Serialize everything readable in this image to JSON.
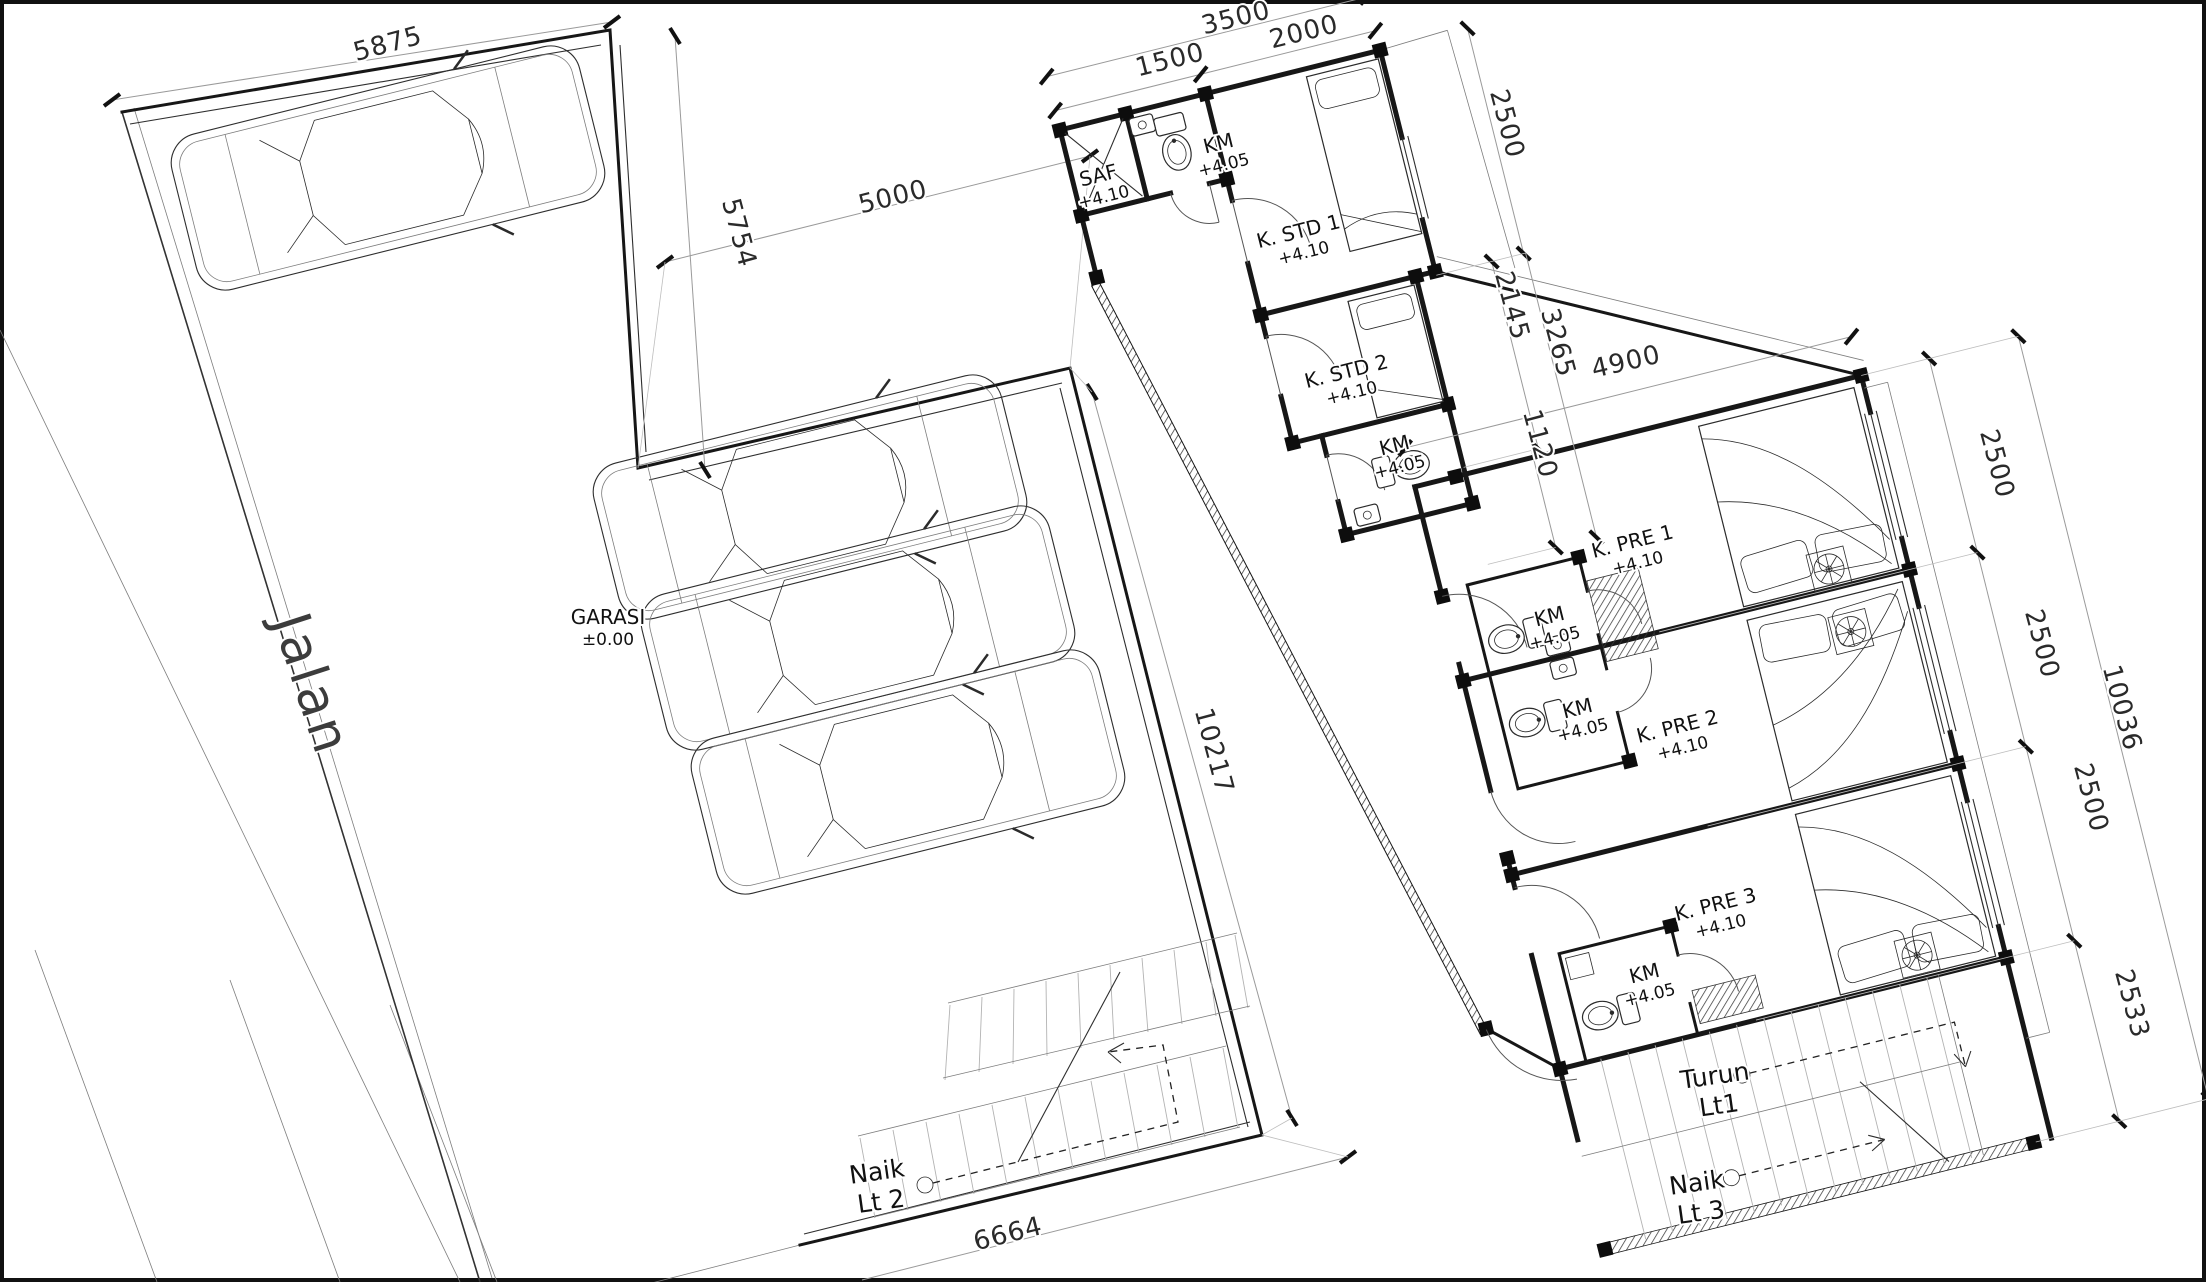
{
  "drawing": {
    "site": {
      "text": "Jalan",
      "x": 295,
      "y": 690,
      "rot": 72
    },
    "rooms": [
      {
        "name": "GARASI",
        "elev": "±0.00",
        "x": 608,
        "y": 624,
        "rot": 0
      },
      {
        "name": "SAF",
        "elev": "+4.10",
        "x": 1100,
        "y": 182,
        "rot": -14
      },
      {
        "name": "KM",
        "elev": "+4.05",
        "x": 1220,
        "y": 150,
        "rot": -14
      },
      {
        "name": "K. STD 1",
        "elev": "+4.10",
        "x": 1300,
        "y": 238,
        "rot": -14
      },
      {
        "name": "K. STD 2",
        "elev": "+4.10",
        "x": 1348,
        "y": 378,
        "rot": -14
      },
      {
        "name": "KM",
        "elev": "+4.05",
        "x": 1396,
        "y": 452,
        "rot": -14
      },
      {
        "name": "K. PRE 1",
        "elev": "+4.10",
        "x": 1634,
        "y": 548,
        "rot": -14
      },
      {
        "name": "KM",
        "elev": "+4.05",
        "x": 1551,
        "y": 623,
        "rot": -14
      },
      {
        "name": "KM",
        "elev": "+4.05",
        "x": 1579,
        "y": 715,
        "rot": -14
      },
      {
        "name": "K. PRE 2",
        "elev": "+4.10",
        "x": 1679,
        "y": 733,
        "rot": -14
      },
      {
        "name": "K. PRE 3",
        "elev": "+4.10",
        "x": 1717,
        "y": 911,
        "rot": -14
      },
      {
        "name": "KM",
        "elev": "+4.05",
        "x": 1646,
        "y": 980,
        "rot": -14
      }
    ],
    "stairs": [
      {
        "line1": "Naik",
        "line2": "Lt 2",
        "x": 878,
        "y": 1180,
        "rot": -8
      },
      {
        "line1": "Turun",
        "line2": "Lt1",
        "x": 1716,
        "y": 1084,
        "rot": -8
      },
      {
        "line1": "Naik",
        "line2": "Lt 3",
        "x": 1698,
        "y": 1191,
        "rot": -8
      }
    ],
    "dimensions": [
      {
        "text": "5875",
        "x": 390,
        "y": 52,
        "rot": -15
      },
      {
        "text": "5754",
        "x": 731,
        "y": 235,
        "rot": 75
      },
      {
        "text": "5000",
        "x": 895,
        "y": 205,
        "rot": -14
      },
      {
        "text": "10217",
        "x": 1206,
        "y": 753,
        "rot": 75
      },
      {
        "text": "6664",
        "x": 1010,
        "y": 1242,
        "rot": -14
      },
      {
        "text": "1500",
        "x": 1172,
        "y": 68,
        "rot": -14
      },
      {
        "text": "3500",
        "x": 1238,
        "y": 26,
        "rot": -14
      },
      {
        "text": "2000",
        "x": 1306,
        "y": 40,
        "rot": -14
      },
      {
        "text": "2500",
        "x": 1499,
        "y": 126,
        "rot": 75
      },
      {
        "text": "2145",
        "x": 1504,
        "y": 308,
        "rot": 75
      },
      {
        "text": "3265",
        "x": 1550,
        "y": 345,
        "rot": 75
      },
      {
        "text": "4900",
        "x": 1628,
        "y": 370,
        "rot": -13
      },
      {
        "text": "1120",
        "x": 1532,
        "y": 446,
        "rot": 75
      },
      {
        "text": "2500",
        "x": 1989,
        "y": 466,
        "rot": 75
      },
      {
        "text": "2500",
        "x": 2034,
        "y": 646,
        "rot": 75
      },
      {
        "text": "2500",
        "x": 2083,
        "y": 800,
        "rot": 75
      },
      {
        "text": "10036",
        "x": 2114,
        "y": 710,
        "rot": 75
      },
      {
        "text": "2533",
        "x": 2124,
        "y": 1006,
        "rot": 75
      }
    ],
    "colors": {
      "line": "#171717",
      "dim": "#9a9a9a",
      "paper": "#ffffff"
    }
  }
}
